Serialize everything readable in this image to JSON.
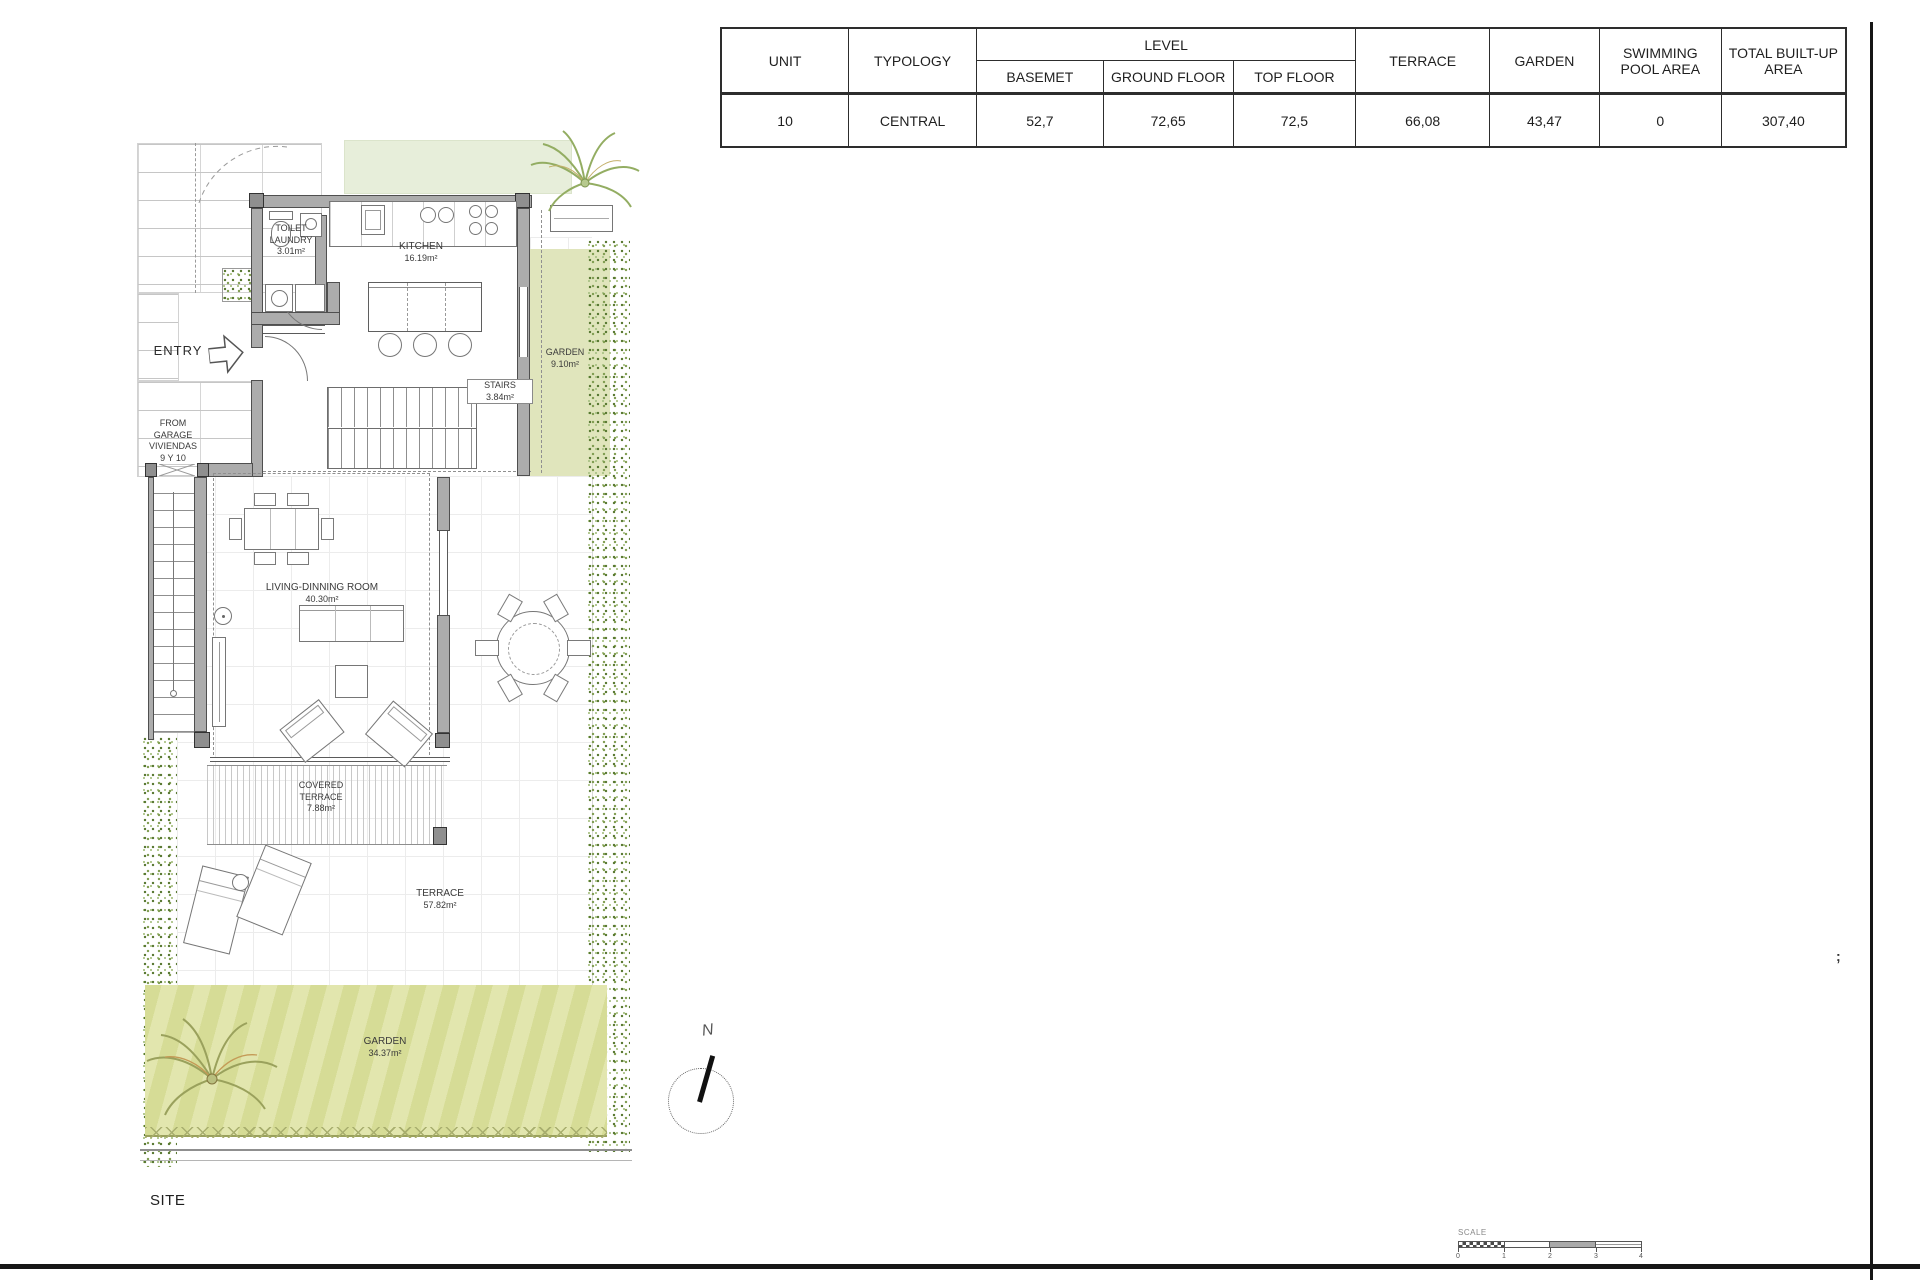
{
  "table": {
    "col_unit": "UNIT",
    "col_typology": "TYPOLOGY",
    "col_level": "LEVEL",
    "col_basement": "BASEMET",
    "col_ground": "GROUND FLOOR",
    "col_top": "TOP FLOOR",
    "col_terrace": "TERRACE",
    "col_garden": "GARDEN",
    "col_pool": "SWIMMING POOL AREA",
    "col_total": "TOTAL BUILT-UP AREA",
    "val_unit": "10",
    "val_typology": "CENTRAL",
    "val_basement": "52,7",
    "val_ground": "72,65",
    "val_top": "72,5",
    "val_terrace": "66,08",
    "val_garden": "43,47",
    "val_pool": "0",
    "val_total": "307,40"
  },
  "plan": {
    "toilet_l1": "TOILET",
    "toilet_l2": "LAUNDRY",
    "toilet_area": "3.01m²",
    "kitchen": "KITCHEN",
    "kitchen_area": "16.19m²",
    "garden_side": "GARDEN",
    "garden_side_area": "9.10m²",
    "stairs": "STAIRS",
    "stairs_area": "3.84m²",
    "entry": "ENTRY",
    "garage_l1": "FROM",
    "garage_l2": "GARAGE",
    "garage_l3": "VIVIENDAS",
    "garage_l4": "9 Y 10",
    "living": "LIVING-DINNING ROOM",
    "living_area": "40.30m²",
    "covered_l1": "COVERED",
    "covered_l2": "TERRACE",
    "covered_area": "7.88m²",
    "terrace": "TERRACE",
    "terrace_area": "57.82m²",
    "garden_main": "GARDEN",
    "garden_main_area": "34.37m²"
  },
  "sheet": {
    "site": "SITE",
    "north": "N",
    "scale": "SCALE",
    "scale_ticks": [
      "0",
      "1",
      "2",
      "3",
      "4"
    ],
    "mark": ";"
  },
  "colors": {
    "garden_fill": "#e0e5bc",
    "hedge_fill": "#e7eeda",
    "stripe_a": "#d6dc96",
    "stripe_b": "#e2e6ae",
    "wall_fill": "#acacac",
    "frame_dark": "#161616"
  }
}
